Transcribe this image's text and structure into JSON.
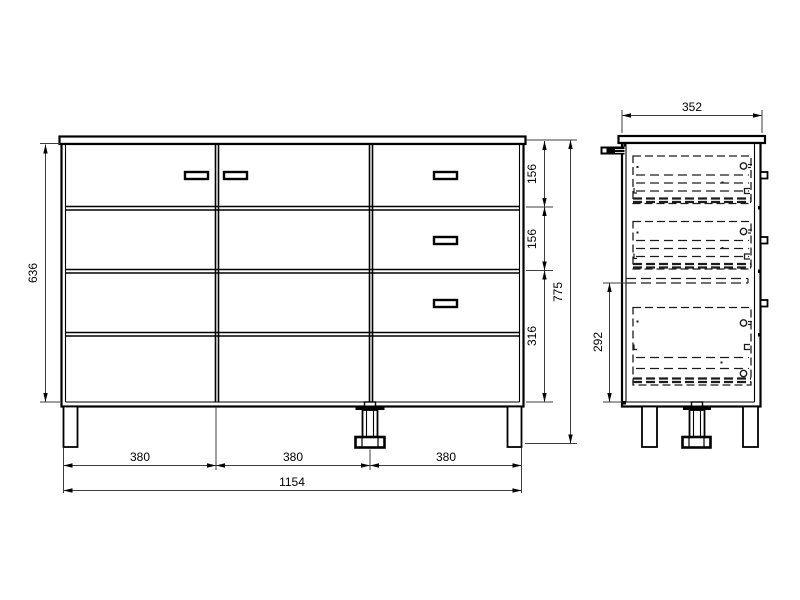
{
  "drawing": {
    "background": "#ffffff",
    "line_color": "#000000",
    "dim_line_color": "#3d3d3d",
    "front_view": {
      "total_width": "1154",
      "column_width_1": "380",
      "column_width_2": "380",
      "column_width_3": "380",
      "carcass_height": "636",
      "total_height": "775",
      "drawer_height_1": "156",
      "drawer_height_2": "156",
      "drawer_height_3": "316"
    },
    "side_view": {
      "depth": "352",
      "lower_section_height": "292"
    }
  }
}
